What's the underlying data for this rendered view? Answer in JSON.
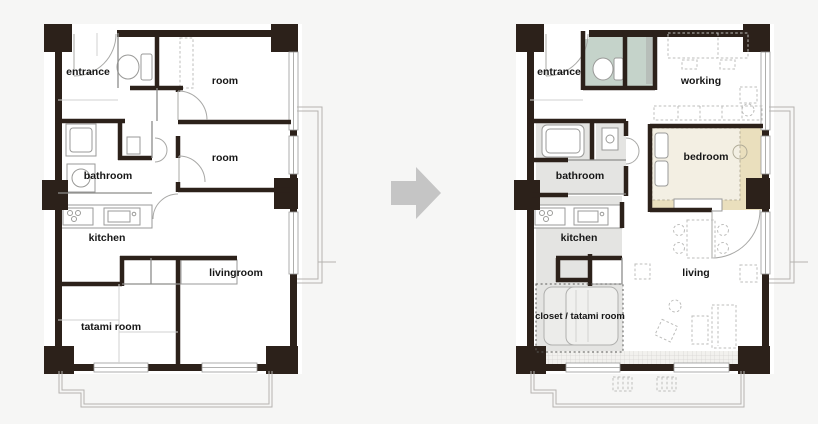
{
  "diagram": {
    "type": "apartment floor plan renovation, before and after",
    "arrow_direction": "right"
  },
  "colors": {
    "background": "#f6f6f5",
    "wall": "#2c211a",
    "arrow": "#c5c5c5",
    "toilet_area_green": "#c5d3ca",
    "fixture_gray_green": "#b7beb9",
    "bedroom_tan": "#eadfbd",
    "wet_area_gray": "#e4e4e2",
    "bed_cream": "#f3efe3",
    "label_text": "#161616"
  },
  "before_plan": {
    "labels": {
      "entrance": "entrance",
      "room_top": "room",
      "room_middle": "room",
      "bathroom": "bathroom",
      "kitchen": "kitchen",
      "livingroom": "livingroom",
      "tatami_room": "tatami room"
    }
  },
  "after_plan": {
    "labels": {
      "entrance": "entrance",
      "working": "working",
      "bathroom": "bathroom",
      "bedroom": "bedroom",
      "kitchen": "kitchen",
      "closet_tatami_room": "closet / tatami room",
      "living": "living"
    }
  }
}
